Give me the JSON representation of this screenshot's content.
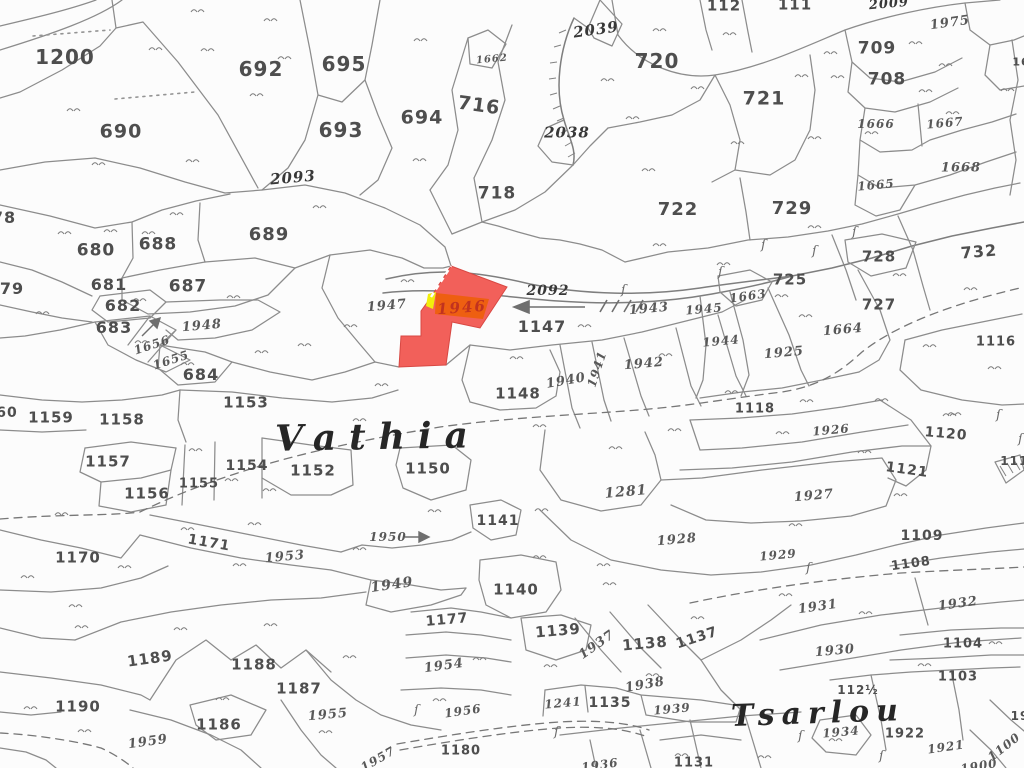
{
  "map": {
    "ink": "#8c8c8c",
    "text_ink": "#4e4e4e",
    "background": "#fcfcfc",
    "highlight": {
      "parcel_number": "1946",
      "fill": "#f2605a",
      "stroke": "#d84843",
      "band_fill": "#ee5f11",
      "label_color": "#c1321f",
      "tick_color": "#f2ee0c",
      "edge_dash_color": "#ffffff",
      "label_x": 462,
      "label_y": 308,
      "label_size": 15,
      "label_rot": -4
    },
    "place_names": [
      {
        "text": "Vathia",
        "x": 378,
        "y": 437,
        "size": 36,
        "spacing": 13,
        "rot": -1
      },
      {
        "text": "Tsarlou",
        "x": 818,
        "y": 714,
        "size": 30,
        "spacing": 7,
        "rot": -2
      }
    ],
    "labels": [
      [
        "1200",
        65,
        57,
        20,
        "p",
        0
      ],
      [
        "692",
        261,
        69,
        20,
        "p",
        0
      ],
      [
        "695",
        344,
        64,
        20,
        "p",
        0
      ],
      [
        "690",
        121,
        132,
        19,
        "p",
        0
      ],
      [
        "693",
        341,
        130,
        20,
        "p",
        0
      ],
      [
        "694",
        422,
        118,
        19,
        "p",
        0
      ],
      [
        "716",
        479,
        106,
        19,
        "p",
        8
      ],
      [
        "718",
        497,
        194,
        17,
        "p",
        0
      ],
      [
        "689",
        269,
        235,
        18,
        "p",
        0
      ],
      [
        "688",
        158,
        245,
        17,
        "p",
        0
      ],
      [
        "680",
        96,
        251,
        17,
        "p",
        0
      ],
      [
        "687",
        188,
        287,
        17,
        "p",
        0
      ],
      [
        "681",
        109,
        285,
        16,
        "p",
        0
      ],
      [
        "682",
        123,
        306,
        16,
        "p",
        0
      ],
      [
        "683",
        114,
        328,
        16,
        "p",
        0
      ],
      [
        "684",
        201,
        375,
        16,
        "p",
        0
      ],
      [
        "1153",
        246,
        403,
        15,
        "p",
        0
      ],
      [
        "1159",
        51,
        418,
        15,
        "p",
        0
      ],
      [
        "1158",
        122,
        420,
        15,
        "p",
        0
      ],
      [
        "1157",
        108,
        462,
        15,
        "p",
        0
      ],
      [
        "1156",
        147,
        494,
        15,
        "p",
        0
      ],
      [
        "1155",
        199,
        484,
        13,
        "p",
        0
      ],
      [
        "1154",
        247,
        466,
        14,
        "p",
        0
      ],
      [
        "1152",
        313,
        471,
        15,
        "p",
        0
      ],
      [
        "1150",
        428,
        469,
        15,
        "p",
        0
      ],
      [
        "1171",
        209,
        543,
        14,
        "p",
        10
      ],
      [
        "1170",
        78,
        558,
        15,
        "p",
        0
      ],
      [
        "1190",
        78,
        707,
        15,
        "p",
        0
      ],
      [
        "1189",
        150,
        659,
        15,
        "p",
        -8
      ],
      [
        "1188",
        254,
        665,
        15,
        "p",
        0
      ],
      [
        "1187",
        299,
        689,
        15,
        "p",
        0
      ],
      [
        "1186",
        219,
        725,
        15,
        "p",
        0
      ],
      [
        "720",
        657,
        61,
        20,
        "p",
        0
      ],
      [
        "721",
        764,
        99,
        19,
        "p",
        0
      ],
      [
        "722",
        678,
        210,
        18,
        "p",
        0
      ],
      [
        "729",
        792,
        209,
        18,
        "p",
        0
      ],
      [
        "709",
        877,
        49,
        17,
        "p",
        0
      ],
      [
        "708",
        887,
        80,
        17,
        "p",
        0
      ],
      [
        "725",
        790,
        280,
        15,
        "p",
        0
      ],
      [
        "727",
        879,
        305,
        15,
        "p",
        0
      ],
      [
        "728",
        879,
        257,
        15,
        "p",
        0
      ],
      [
        "732",
        979,
        252,
        16,
        "p",
        -5
      ],
      [
        "112",
        724,
        6,
        15,
        "p",
        0
      ],
      [
        "111",
        795,
        5,
        15,
        "p",
        0
      ],
      [
        "1147",
        542,
        327,
        16,
        "p",
        0
      ],
      [
        "1148",
        518,
        394,
        15,
        "p",
        0
      ],
      [
        "1118",
        755,
        409,
        13,
        "p",
        0
      ],
      [
        "1116",
        996,
        342,
        13,
        "p",
        0
      ],
      [
        "1120",
        946,
        434,
        14,
        "p",
        5
      ],
      [
        "1121",
        907,
        470,
        14,
        "p",
        8
      ],
      [
        "1109",
        922,
        536,
        14,
        "p",
        0
      ],
      [
        "1108",
        911,
        564,
        13,
        "p",
        -8
      ],
      [
        "1104",
        963,
        644,
        13,
        "p",
        0
      ],
      [
        "1103",
        958,
        677,
        13,
        "p",
        0
      ],
      [
        "1177",
        447,
        620,
        14,
        "p",
        -5
      ],
      [
        "1180",
        461,
        751,
        13,
        "p",
        0
      ],
      [
        "1139",
        558,
        631,
        15,
        "p",
        -5
      ],
      [
        "1140",
        516,
        590,
        15,
        "p",
        0
      ],
      [
        "1141",
        498,
        521,
        14,
        "p",
        0
      ],
      [
        "1138",
        645,
        644,
        15,
        "p",
        -5
      ],
      [
        "1137",
        697,
        638,
        14,
        "p",
        -18
      ],
      [
        "1135",
        610,
        703,
        14,
        "p",
        0
      ],
      [
        "1131",
        694,
        763,
        13,
        "p",
        0
      ],
      [
        "1922",
        905,
        734,
        13,
        "p",
        0
      ],
      [
        "112½",
        858,
        690,
        12,
        "p",
        0
      ],
      [
        "78",
        4,
        218,
        16,
        "p",
        0
      ],
      [
        "79",
        12,
        289,
        16,
        "p",
        0
      ],
      [
        "60",
        7,
        413,
        14,
        "p",
        0
      ],
      [
        "1114",
        1019,
        461,
        12,
        "p",
        0
      ],
      [
        "19",
        1020,
        716,
        12,
        "p",
        0
      ],
      [
        "16",
        1021,
        62,
        11,
        "p",
        0
      ],
      [
        "1662",
        492,
        60,
        10,
        "k",
        -5
      ],
      [
        "1666",
        876,
        124,
        12,
        "k",
        0
      ],
      [
        "1667",
        945,
        123,
        12,
        "k",
        -5
      ],
      [
        "1668",
        961,
        168,
        13,
        "k",
        0
      ],
      [
        "1665",
        876,
        185,
        12,
        "k",
        -5
      ],
      [
        "1975",
        950,
        23,
        13,
        "k",
        -8
      ],
      [
        "1663",
        748,
        296,
        12,
        "k",
        -8
      ],
      [
        "1664",
        843,
        330,
        13,
        "k",
        -5
      ],
      [
        "1945",
        704,
        309,
        12,
        "k",
        -5
      ],
      [
        "1943",
        649,
        309,
        13,
        "k",
        -5
      ],
      [
        "1944",
        721,
        341,
        12,
        "k",
        -5
      ],
      [
        "1925",
        784,
        353,
        13,
        "k",
        -5
      ],
      [
        "1947",
        387,
        306,
        13,
        "k",
        -5
      ],
      [
        "1942",
        644,
        364,
        13,
        "k",
        -5
      ],
      [
        "1941",
        597,
        369,
        12,
        "k",
        -72
      ],
      [
        "1940",
        566,
        381,
        13,
        "k",
        -10
      ],
      [
        "1948",
        202,
        326,
        13,
        "k",
        -5
      ],
      [
        "1656",
        152,
        345,
        12,
        "k",
        -18
      ],
      [
        "1655",
        171,
        360,
        12,
        "k",
        -18
      ],
      [
        "1926",
        831,
        430,
        12,
        "k",
        -5
      ],
      [
        "1281",
        626,
        492,
        14,
        "k",
        -5
      ],
      [
        "1927",
        814,
        496,
        13,
        "k",
        -5
      ],
      [
        "1928",
        677,
        540,
        13,
        "k",
        -5
      ],
      [
        "1929",
        778,
        555,
        12,
        "k",
        -5
      ],
      [
        "1953",
        285,
        557,
        13,
        "k",
        -5
      ],
      [
        "1950",
        388,
        537,
        12,
        "k",
        0
      ],
      [
        "1949",
        392,
        585,
        14,
        "k",
        -8
      ],
      [
        "1954",
        444,
        666,
        13,
        "k",
        -8
      ],
      [
        "1956",
        463,
        711,
        12,
        "k",
        -8
      ],
      [
        "1955",
        328,
        715,
        13,
        "k",
        -5
      ],
      [
        "1959",
        148,
        742,
        13,
        "k",
        -8
      ],
      [
        "1957",
        378,
        759,
        12,
        "k",
        -30
      ],
      [
        "1937",
        597,
        645,
        13,
        "k",
        -35
      ],
      [
        "1938",
        645,
        685,
        13,
        "k",
        -10
      ],
      [
        "1939",
        672,
        709,
        12,
        "k",
        -5
      ],
      [
        "1931",
        818,
        607,
        13,
        "k",
        -8
      ],
      [
        "1930",
        835,
        651,
        13,
        "k",
        -5
      ],
      [
        "1932",
        958,
        604,
        13,
        "k",
        -8
      ],
      [
        "1934",
        841,
        732,
        12,
        "k",
        -5
      ],
      [
        "1921",
        946,
        747,
        12,
        "k",
        -8
      ],
      [
        "1241",
        563,
        703,
        12,
        "k",
        -5
      ],
      [
        "1936",
        600,
        765,
        12,
        "k",
        -8
      ],
      [
        "1900",
        979,
        766,
        12,
        "k",
        -10
      ],
      [
        "1100",
        1004,
        747,
        12,
        "k",
        -38
      ],
      [
        "2092",
        548,
        291,
        14,
        "b",
        0
      ],
      [
        "2093",
        293,
        178,
        15,
        "b",
        -5
      ],
      [
        "2039",
        596,
        30,
        15,
        "b",
        -8
      ],
      [
        "2038",
        567,
        133,
        15,
        "b",
        0
      ],
      [
        "2009",
        889,
        4,
        13,
        "b",
        -5
      ]
    ],
    "symbols": {
      "grass_tufts": [
        [
          198,
          11
        ],
        [
          271,
          20
        ],
        [
          156,
          49
        ],
        [
          208,
          50
        ],
        [
          285,
          58
        ],
        [
          421,
          40
        ],
        [
          74,
          110
        ],
        [
          257,
          95
        ],
        [
          99,
          164
        ],
        [
          193,
          161
        ],
        [
          320,
          207
        ],
        [
          420,
          160
        ],
        [
          177,
          214
        ],
        [
          111,
          231
        ],
        [
          65,
          233
        ],
        [
          149,
          233
        ],
        [
          660,
          30
        ],
        [
          730,
          34
        ],
        [
          608,
          80
        ],
        [
          698,
          88
        ],
        [
          633,
          118
        ],
        [
          831,
          53
        ],
        [
          916,
          43
        ],
        [
          946,
          65
        ],
        [
          802,
          76
        ],
        [
          838,
          77
        ],
        [
          926,
          91
        ],
        [
          1008,
          90
        ],
        [
          815,
          138
        ],
        [
          738,
          143
        ],
        [
          649,
          170
        ],
        [
          660,
          245
        ],
        [
          815,
          227
        ],
        [
          872,
          133
        ],
        [
          953,
          113
        ],
        [
          43,
          313
        ],
        [
          140,
          300
        ],
        [
          234,
          297
        ],
        [
          142,
          342
        ],
        [
          188,
          364
        ],
        [
          262,
          352
        ],
        [
          305,
          345
        ],
        [
          351,
          326
        ],
        [
          408,
          281
        ],
        [
          382,
          385
        ],
        [
          517,
          358
        ],
        [
          585,
          326
        ],
        [
          666,
          355
        ],
        [
          782,
          296
        ],
        [
          900,
          275
        ],
        [
          971,
          289
        ],
        [
          724,
          264
        ],
        [
          806,
          316
        ],
        [
          930,
          346
        ],
        [
          995,
          368
        ],
        [
          732,
          392
        ],
        [
          807,
          401
        ],
        [
          882,
          400
        ],
        [
          955,
          414
        ],
        [
          62,
          514
        ],
        [
          188,
          529
        ],
        [
          255,
          524
        ],
        [
          360,
          549
        ],
        [
          196,
          450
        ],
        [
          232,
          480
        ],
        [
          270,
          490
        ],
        [
          360,
          420
        ],
        [
          435,
          511
        ],
        [
          540,
          426
        ],
        [
          675,
          430
        ],
        [
          783,
          433
        ],
        [
          865,
          452
        ],
        [
          950,
          415
        ],
        [
          616,
          448
        ],
        [
          542,
          510
        ],
        [
          796,
          525
        ],
        [
          901,
          495
        ],
        [
          604,
          565
        ],
        [
          540,
          557
        ],
        [
          28,
          577
        ],
        [
          125,
          567
        ],
        [
          76,
          606
        ],
        [
          82,
          627
        ],
        [
          181,
          629
        ],
        [
          271,
          625
        ],
        [
          350,
          657
        ],
        [
          440,
          700
        ],
        [
          31,
          708
        ],
        [
          85,
          731
        ],
        [
          223,
          699
        ],
        [
          240,
          565
        ],
        [
          326,
          732
        ],
        [
          480,
          659
        ],
        [
          610,
          584
        ],
        [
          698,
          618
        ],
        [
          551,
          666
        ],
        [
          653,
          675
        ],
        [
          786,
          595
        ],
        [
          866,
          613
        ],
        [
          925,
          665
        ],
        [
          996,
          643
        ],
        [
          836,
          740
        ],
        [
          765,
          757
        ],
        [
          682,
          755
        ]
      ],
      "spring_marks": [
        [
          718,
          276
        ],
        [
          761,
          249
        ],
        [
          812,
          255
        ],
        [
          852,
          236
        ],
        [
          621,
          294
        ],
        [
          806,
          572
        ],
        [
          798,
          740
        ],
        [
          879,
          760
        ],
        [
          554,
          736
        ],
        [
          414,
          714
        ],
        [
          1018,
          443
        ],
        [
          996,
          419
        ]
      ],
      "road_arrow": {
        "x1": 585,
        "y1": 307,
        "x2": 515,
        "y2": 307,
        "direction": "left"
      },
      "parcel_1950_arrow": {
        "x1": 405,
        "y1": 537,
        "x2": 428,
        "y2": 537,
        "direction": "right"
      },
      "parcel_1656_arrow": {
        "x1": 142,
        "y1": 336,
        "x2": 160,
        "y2": 318,
        "direction": "north-east"
      }
    }
  }
}
